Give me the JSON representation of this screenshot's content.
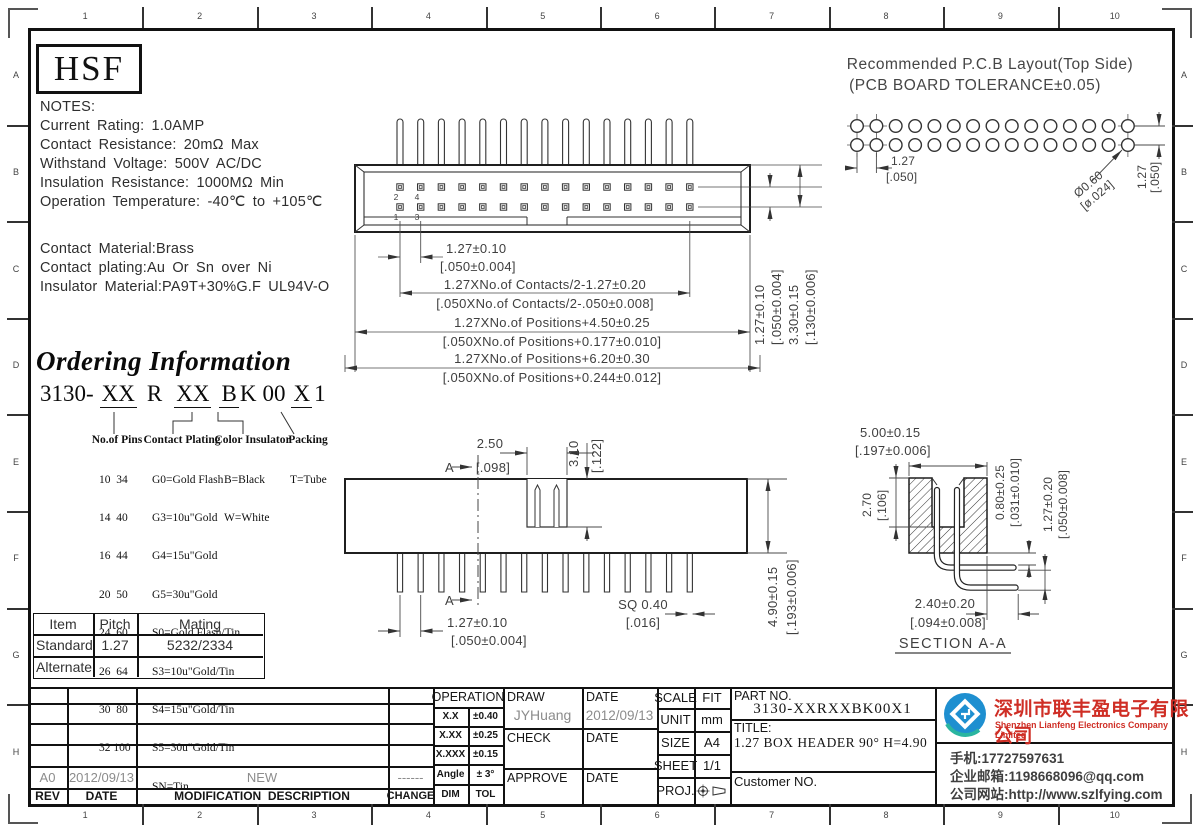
{
  "frame": {
    "cols": [
      "1",
      "2",
      "3",
      "4",
      "5",
      "6",
      "7",
      "8",
      "9",
      "10"
    ],
    "rows": [
      "A",
      "B",
      "C",
      "D",
      "E",
      "F",
      "G",
      "H"
    ]
  },
  "logo_text": "HSF",
  "notes": {
    "heading": "NOTES:",
    "line1": "Current Rating: 1.0AMP",
    "line2": "Contact Resistance: 20mΩ Max",
    "line3": "Withstand Voltage: 500V AC/DC",
    "line4": "Insulation Resistance: 1000MΩ Min",
    "line5": "Operation Temperature: -40℃ to +105℃",
    "mat1": "Contact Material:Brass",
    "mat2": "Contact plating:Au Or Sn over Ni",
    "mat3": "Insulator Material:PA9T+30%G.F UL94V-O"
  },
  "pcb": {
    "title1": "Recommended P.C.B Layout(Top Side)",
    "title2": "(PCB BOARD TOLERANCE±0.05)",
    "pm": "1.27",
    "pi": "[.050]",
    "hm": "Ø0.60",
    "hi": "[ø.024]",
    "vm": "1.27",
    "vi": "[.050]"
  },
  "top_view": {
    "n1": "1",
    "n2": "2",
    "n3": "3",
    "n4": "4",
    "d1m": "1.27±0.10",
    "d1i": "[.050±0.004]",
    "d2m": "1.27XNo.of Contacts/2-1.27±0.20",
    "d2i": "[.050XNo.of Contacts/2-.050±0.008]",
    "d3m": "1.27XNo.of Positions+4.50±0.25",
    "d3i": "[.050XNo.of Positions+0.177±0.010]",
    "d4m": "1.27XNo.of Positions+6.20±0.30",
    "d4i": "[.050XNo.of Positions+0.244±0.012]",
    "r1m": "1.27±0.10",
    "r1i": "[.050±0.004]",
    "r2m": "3.30±0.15",
    "r2i": "[.130±0.006]"
  },
  "ordering": {
    "title": "Ordering Information",
    "code": {
      "base": "3130-",
      "p1": "XX",
      "p2": "R",
      "p3": "XX",
      "p4": "B",
      "p5": "K",
      "p6": "00",
      "p7": "X",
      "p8": "1"
    },
    "col1": {
      "header": "No.of Pins",
      "items": [
        "10  34",
        "14  40",
        "16  44",
        "20  50",
        "24  60",
        "26  64",
        "30  80",
        "32 100"
      ]
    },
    "col2": {
      "header": "Contact Plating",
      "items": [
        "G0=Gold Flash",
        "G3=10u\"Gold",
        "G4=15u\"Gold",
        "G5=30u\"Gold",
        "S0=Gold Flash/Tin",
        "S3=10u\"Gold/Tin",
        "S4=15u\"Gold/Tin",
        "S5=30u\"Gold/Tin",
        "SN=Tin"
      ]
    },
    "col3": {
      "header": "Color Insulator",
      "items": [
        "B=Black",
        "W=White"
      ]
    },
    "col4": {
      "header": "Packing",
      "items": [
        "T=Tube"
      ]
    }
  },
  "front_view": {
    "a_top": "A",
    "a_bot": "A",
    "dnm": "2.50",
    "dni": "[.098]",
    "ddm": "3.10",
    "ddi": "[.122]",
    "dpm": "1.27±0.10",
    "dpi": "[.050±0.004]",
    "dsm": "SQ 0.40",
    "dsi": "[.016]",
    "dhm": "4.90±0.15",
    "dhi": "[.193±0.006]"
  },
  "section": {
    "dwm": "5.00±0.15",
    "dwi": "[.197±0.006]",
    "dcm": "2.70",
    "dci": "[.106]",
    "dpm": "0.80±0.25",
    "dpi": "[.031±0.010]",
    "drm": "1.27±0.20",
    "dri": "[.050±0.008]",
    "dtm": "2.40±0.20",
    "dti": "[.094±0.008]",
    "label": "SECTION A-A"
  },
  "mating": {
    "h1": "Item",
    "h2": "Pitch",
    "h3": "Mating",
    "r1c1": "Standard",
    "r1c2": "1.27",
    "r1c3": "5232/2334",
    "r2c1": "Alternate"
  },
  "revision": {
    "rev": "A0",
    "date": "2012/09/13",
    "desc": "NEW",
    "change": "------",
    "h_rev": "REV",
    "h_date": "DATE",
    "h_desc": "MODIFICATION  DESCRIPTION",
    "h_change": "CHANGE"
  },
  "titleblock": {
    "op_header": "OPERATION",
    "op_r1l": "X.X",
    "op_r1v": "±0.40",
    "op_r2l": "X.XX",
    "op_r2v": "±0.25",
    "op_r3l": "X.XXX",
    "op_r3v": "±0.15",
    "op_r4l": "Angle",
    "op_r4v": "± 3°",
    "op_r5l": "DIM",
    "op_r5v": "TOL",
    "draw_label": "DRAW",
    "draw_value": "JYHuang",
    "date_label1": "DATE",
    "date_value1": "2012/09/13",
    "check_label": "CHECK",
    "date_label2": "DATE",
    "approve_label": "APPROVE",
    "date_label3": "DATE",
    "scale_label": "SCALE",
    "scale_value": "FIT",
    "unit_label": "UNIT",
    "unit_value": "mm",
    "size_label": "SIZE",
    "size_value": "A4",
    "sheet_label": "SHEET",
    "sheet_value": "1/1",
    "proj_label": "PROJ.",
    "part_label": "PART NO.",
    "part_value": "3130-XXRXXBK00X1",
    "title_label": "TITLE:",
    "title_value": "1.27 BOX HEADER 90° H=4.90",
    "customer_label": "Customer NO."
  },
  "company": {
    "cn": "深圳市联丰盈电子有限公司",
    "en": "Shenzhen Lianfeng Electronics Company Limited",
    "phone": "手机:17727597631",
    "email": "企业邮箱:1198668096@qq.com",
    "web": "公司网站:http://www.szlfying.com"
  }
}
